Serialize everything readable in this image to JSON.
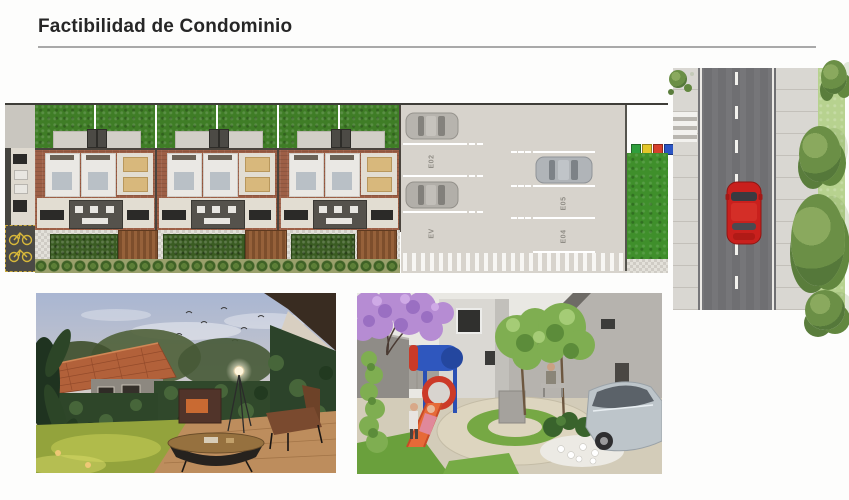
{
  "page": {
    "title": "Factibilidad de Condominio"
  },
  "site_plan": {
    "parking": {
      "left_column": [
        {
          "label": "E03",
          "occupied": true
        },
        {
          "label": "E02",
          "occupied": false
        },
        {
          "label": "E01",
          "occupied": true
        },
        {
          "label": "EV",
          "occupied": false
        }
      ],
      "right_column": [
        {
          "label": "E06",
          "occupied": true
        },
        {
          "label": "E05",
          "occupied": false
        },
        {
          "label": "E04",
          "occupied": false
        }
      ]
    },
    "recycling_bin_colors": [
      "#2f9e3c",
      "#e3c629",
      "#d6402c",
      "#2b55c4"
    ]
  },
  "street": {
    "car_color": "#c9201d"
  },
  "colors": {
    "lawn_green": "#3f8f2b",
    "brick": "#9d5f46",
    "asphalt": "#6f6f72",
    "paver": "#e3e1da",
    "parking_gray": "#d7d3cc"
  }
}
